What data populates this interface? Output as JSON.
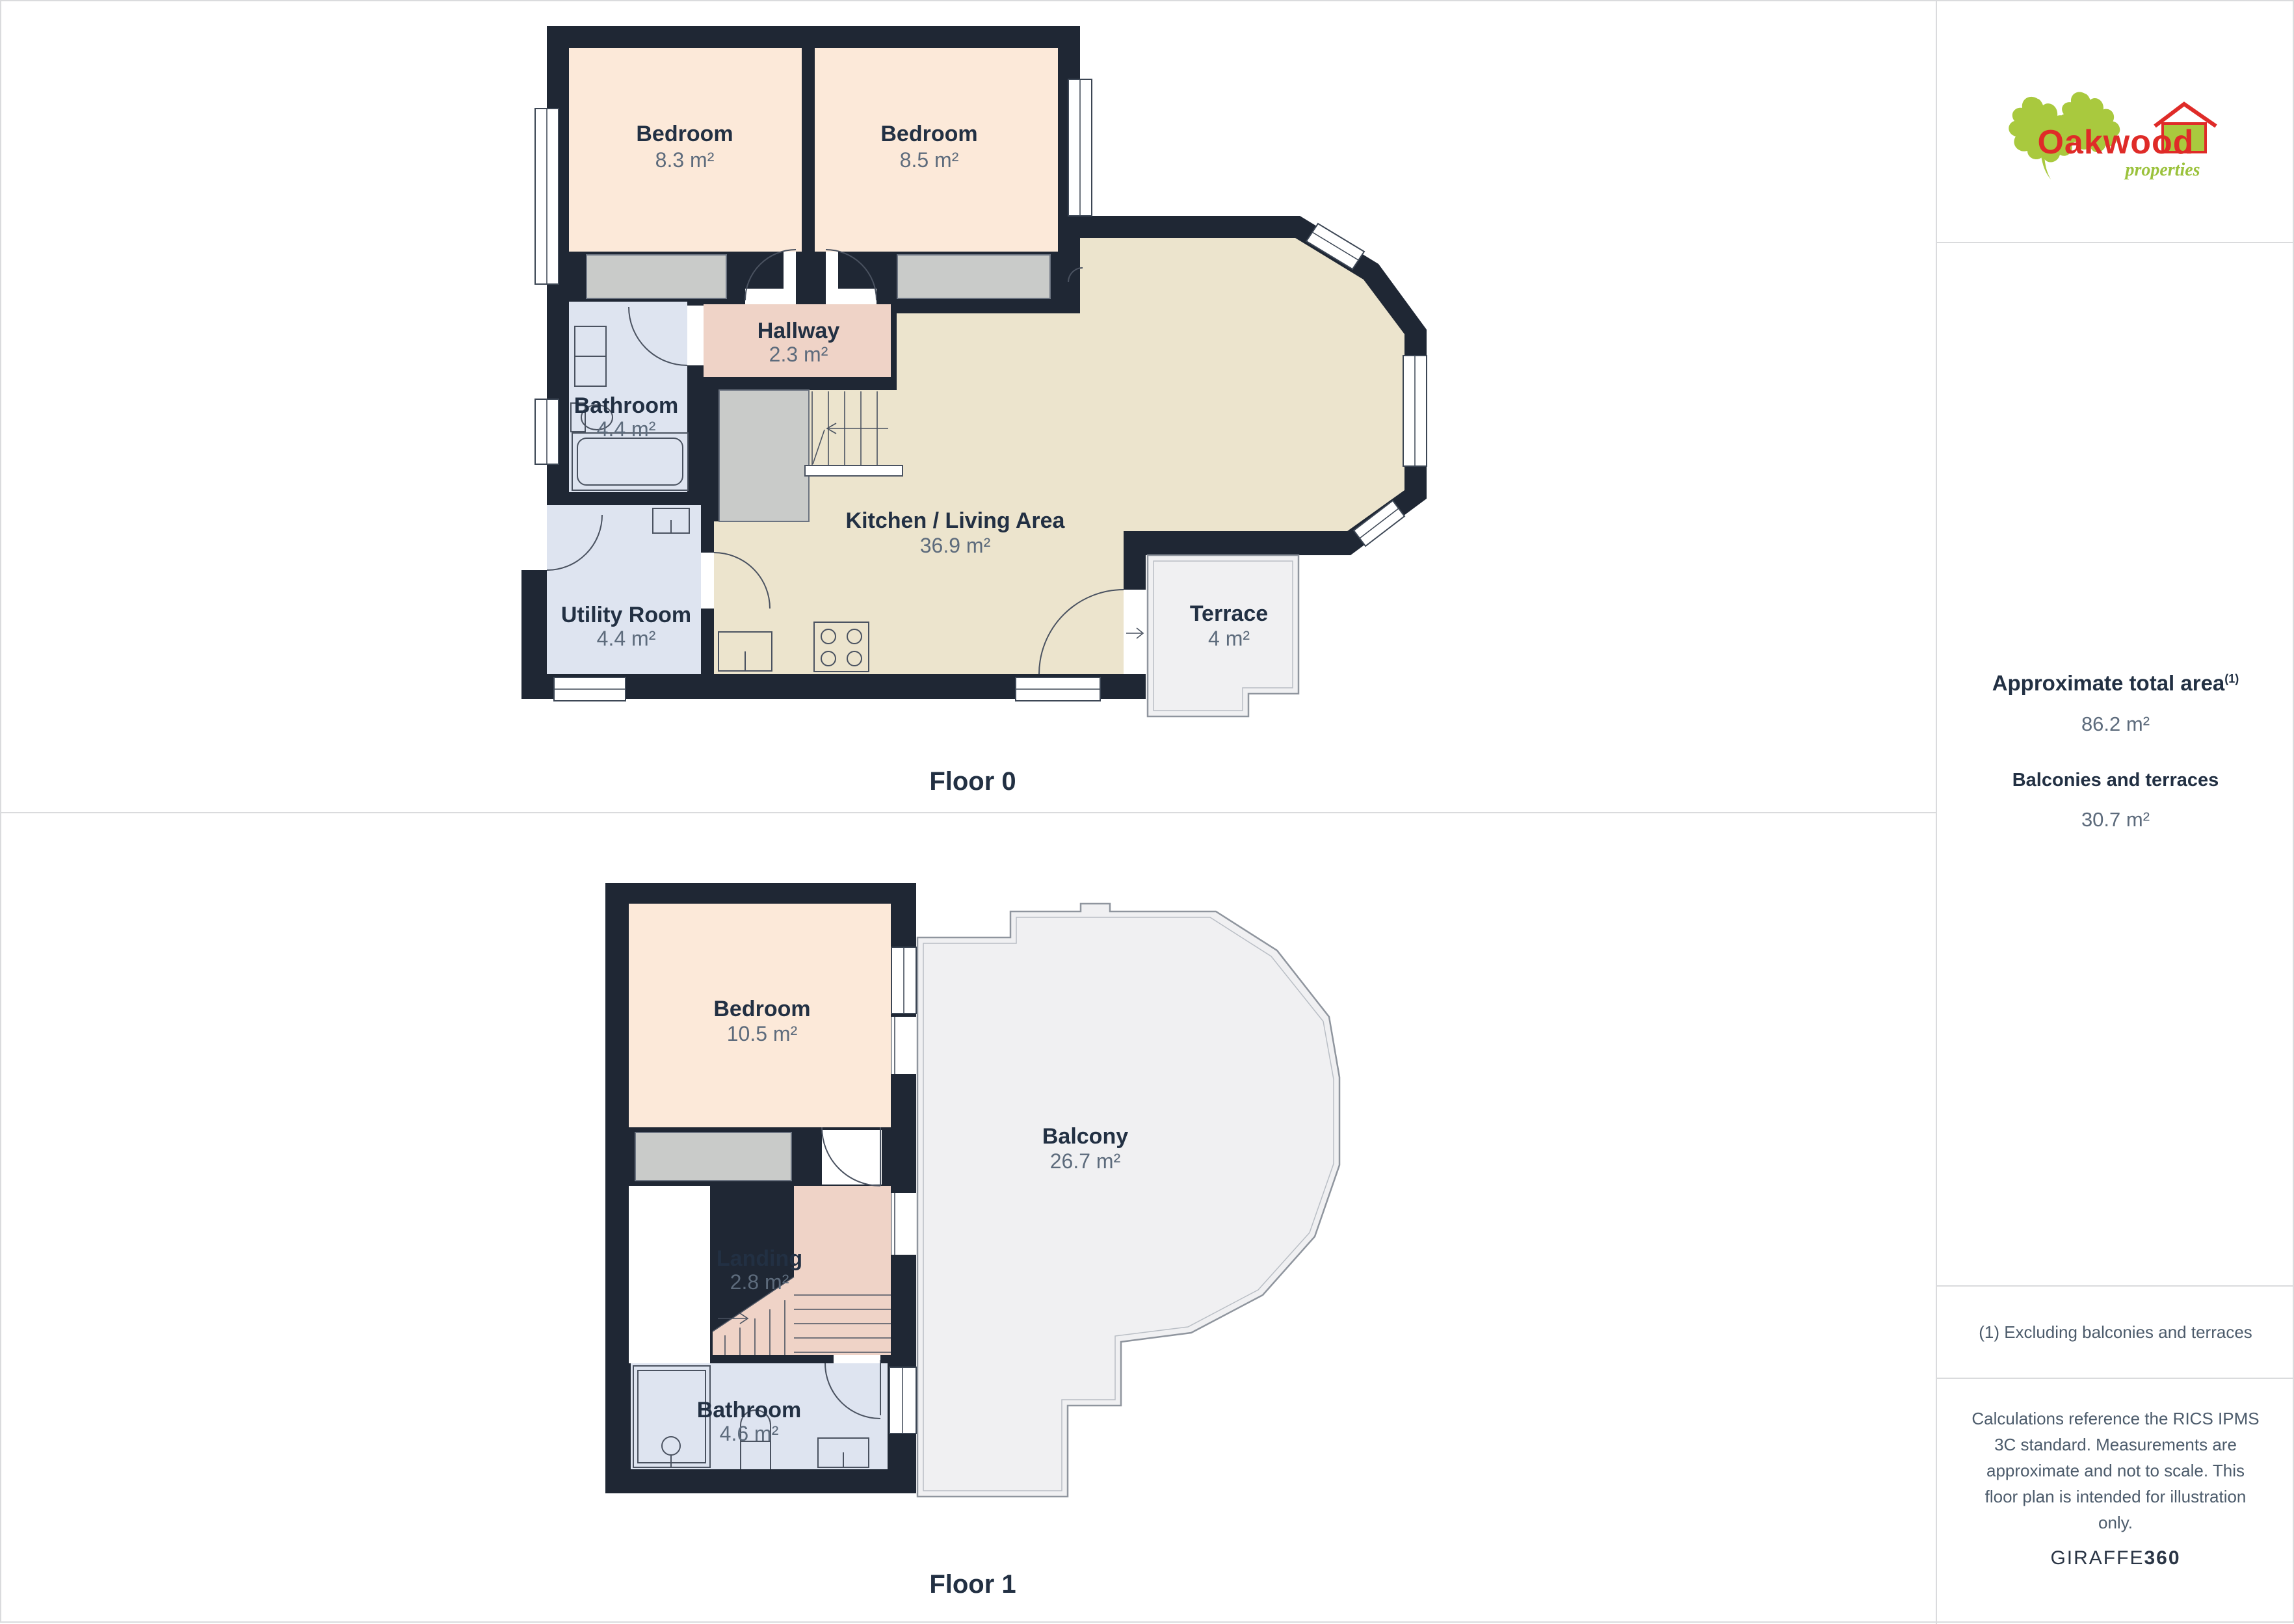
{
  "floors": [
    {
      "label": "Floor 0",
      "rooms": [
        {
          "name": "Bedroom",
          "area": "8.3 m²"
        },
        {
          "name": "Bedroom",
          "area": "8.5 m²"
        },
        {
          "name": "Hallway",
          "area": "2.3 m²"
        },
        {
          "name": "Bathroom",
          "area": "4.4 m²"
        },
        {
          "name": "Utility Room",
          "area": "4.4 m²"
        },
        {
          "name": "Kitchen / Living Area",
          "area": "36.9 m²"
        },
        {
          "name": "Terrace",
          "area": "4 m²"
        }
      ]
    },
    {
      "label": "Floor 1",
      "rooms": [
        {
          "name": "Bedroom",
          "area": "10.5 m²"
        },
        {
          "name": "Balcony",
          "area": "26.7 m²"
        },
        {
          "name": "Landing",
          "area": "2.8 m²"
        },
        {
          "name": "Bathroom",
          "area": "4.6 m²"
        }
      ]
    }
  ],
  "sidebar": {
    "logo": {
      "brand": "Oakwood",
      "sub": "properties"
    },
    "total_area_label": "Approximate total area",
    "total_area_sup": "(1)",
    "total_area_value": "86.2 m²",
    "balconies_label": "Balconies and terraces",
    "balconies_value": "30.7 m²",
    "footnote": "(1) Excluding balconies and terraces",
    "disclaimer_lines": [
      "Calculations reference the RICS IPMS",
      "3C standard. Measurements are",
      "approximate and not to scale. This",
      "floor plan is intended for illustration",
      "only."
    ],
    "credit_regular": "GIRAFFE",
    "credit_bold": "360"
  },
  "colors": {
    "wall": "#1f2734",
    "bedroom_fill": "#fce9d9",
    "hallway_fill": "#efd3c7",
    "bathroom_fill": "#dee4f0",
    "kitchen_fill": "#ece4cd",
    "terrace_fill": "#f0f0f2",
    "closet_fill": "#c9cbc9",
    "label_text": "#223043",
    "area_text": "#5d6b7c",
    "divider": "#dadbdd",
    "brand_red": "#df2b28",
    "brand_green": "#a9c93e"
  }
}
